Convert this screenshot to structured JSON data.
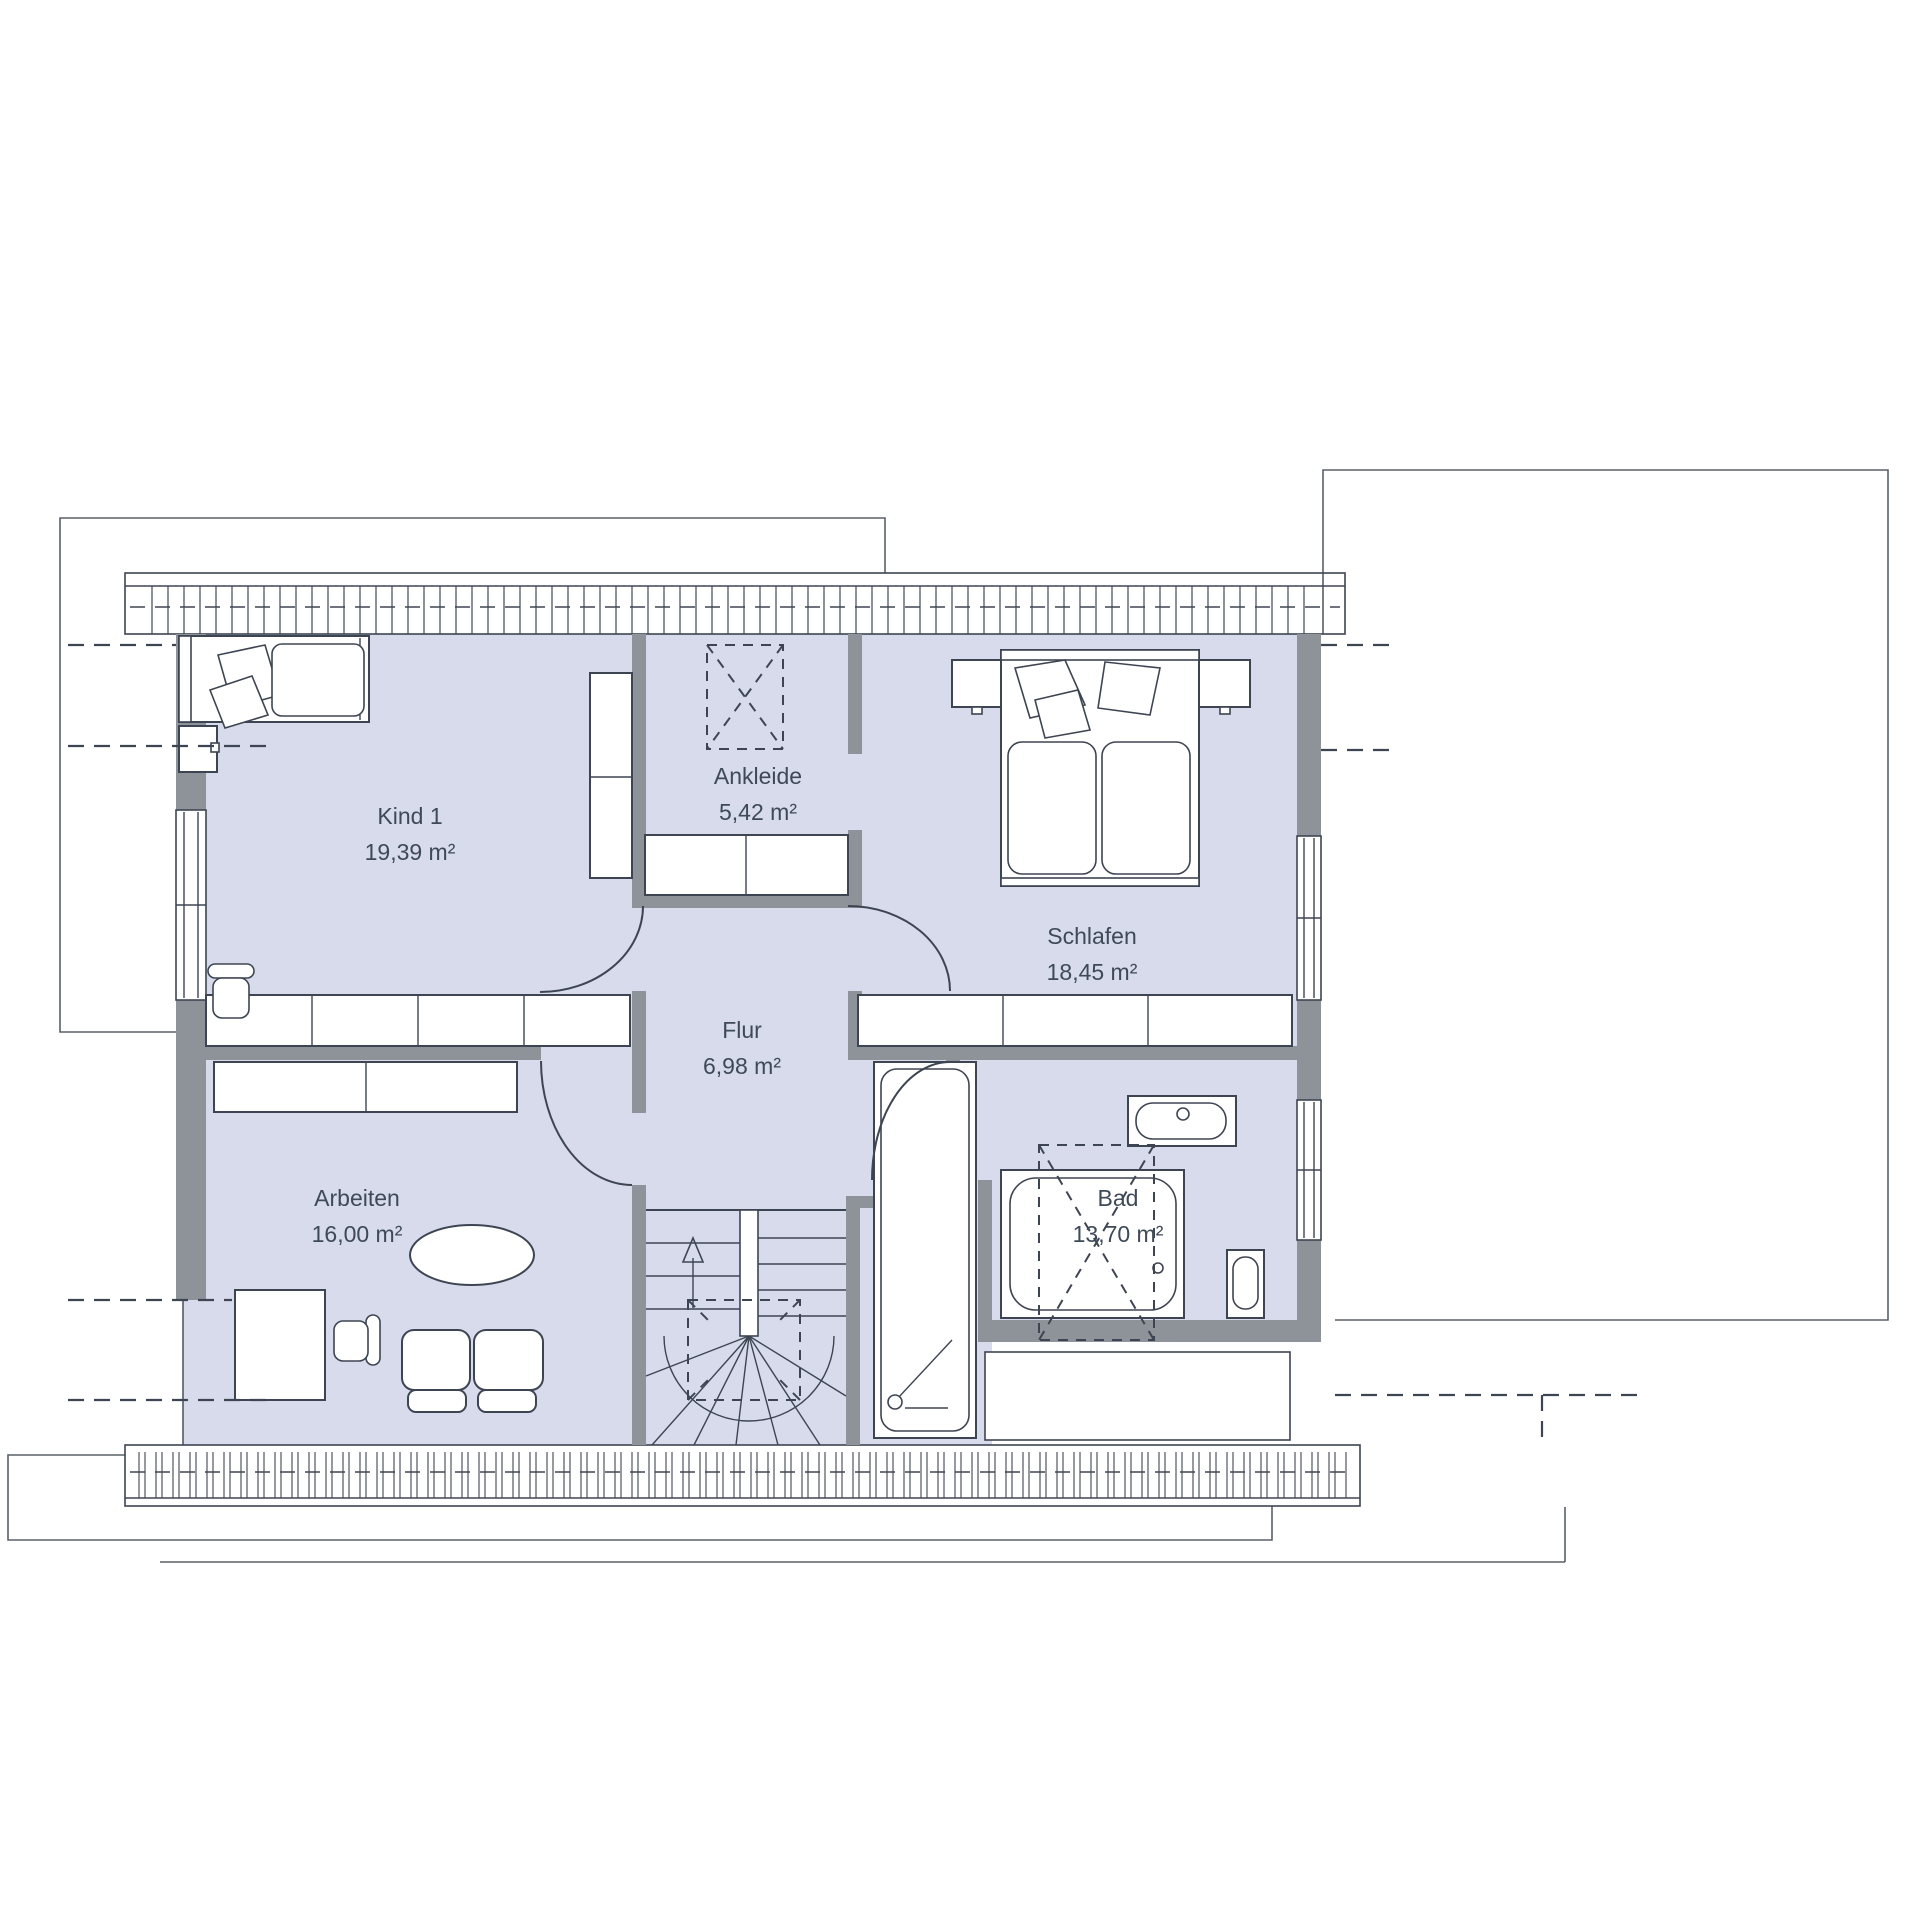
{
  "colors": {
    "background": "#ffffff",
    "room_fill": "#d7dbec",
    "wall_gray": "#8e9299",
    "line_dark": "#3e4552",
    "text": "#3e4a57"
  },
  "plan": {
    "type": "floor-plan",
    "rooms": [
      {
        "id": "kind1",
        "name": "Kind 1",
        "area": "19,39 m²"
      },
      {
        "id": "ankleide",
        "name": "Ankleide",
        "area": "5,42 m²"
      },
      {
        "id": "schlafen",
        "name": "Schlafen",
        "area": "18,45 m²"
      },
      {
        "id": "flur",
        "name": "Flur",
        "area": "6,98 m²"
      },
      {
        "id": "arbeiten",
        "name": "Arbeiten",
        "area": "16,00 m²"
      },
      {
        "id": "bad",
        "name": "Bad",
        "area": "13,70 m²"
      }
    ]
  }
}
